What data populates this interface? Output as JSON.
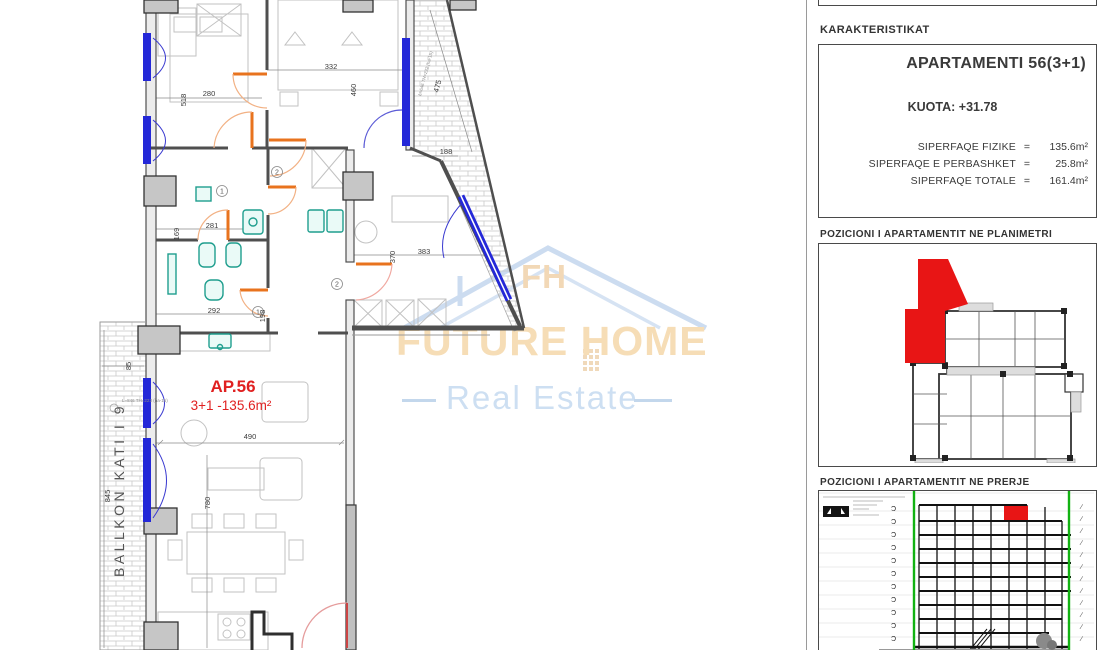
{
  "right_panel": {
    "karakteristikat": "KARAKTERISTIKAT",
    "apartment_title": "APARTAMENTI 56(3+1)",
    "kuota": "KUOTA: +31.78",
    "equals_sign": "=",
    "areas": [
      {
        "label": "SIPERFAQE  FIZIKE",
        "value": "135.6m²"
      },
      {
        "label": "SIPERFAQE E PERBASHKET",
        "value": "25.8m²"
      },
      {
        "label": "SIPERFAQE TOTALE",
        "value": "161.4m²"
      }
    ],
    "planimetri_title": "POZICIONI I APARTAMENTIT NE PLANIMETRI",
    "prerje_title": "POZICIONI I APARTAMENTIT NE PRERJE"
  },
  "plan": {
    "unit_label": "AP.56",
    "unit_details": "3+1 -135.6m²",
    "balcony_label": "BALLKON KATI I 9",
    "dimensions": {
      "bedroom1_height": "518",
      "bedroom1_width": "280",
      "bedroom2_width": "332",
      "bedroom2_height": "460",
      "balcony_right_width": "188",
      "balcony_right_length": "475",
      "bath1_height": "169",
      "bath1_width": "281",
      "bath2_width": "292",
      "bath2_height": "198",
      "room3_width": "383",
      "room3_height": "370",
      "balcony_left_width": "85",
      "balcony_left_height": "845",
      "living_width": "490",
      "living_height": "780"
    },
    "door_tags": [
      "1",
      "2",
      "2",
      "1"
    ],
    "window_spec_1": "L=646 TH=222 (ha-15)",
    "window_spec_2": "L=846 TH=223 (ha-15)"
  },
  "watermark": {
    "monogram": "FH",
    "brand": "FUTURE HOME",
    "tagline": "Real Estate"
  },
  "colors": {
    "highlight_red": "#e81515",
    "window_blue": "#2428d8",
    "door_orange": "#e8731e",
    "fixture_teal": "#1f9e8e",
    "section_green": "#12b212",
    "watermark_orange": "#f6ddb6",
    "watermark_blue": "#cddff2"
  }
}
